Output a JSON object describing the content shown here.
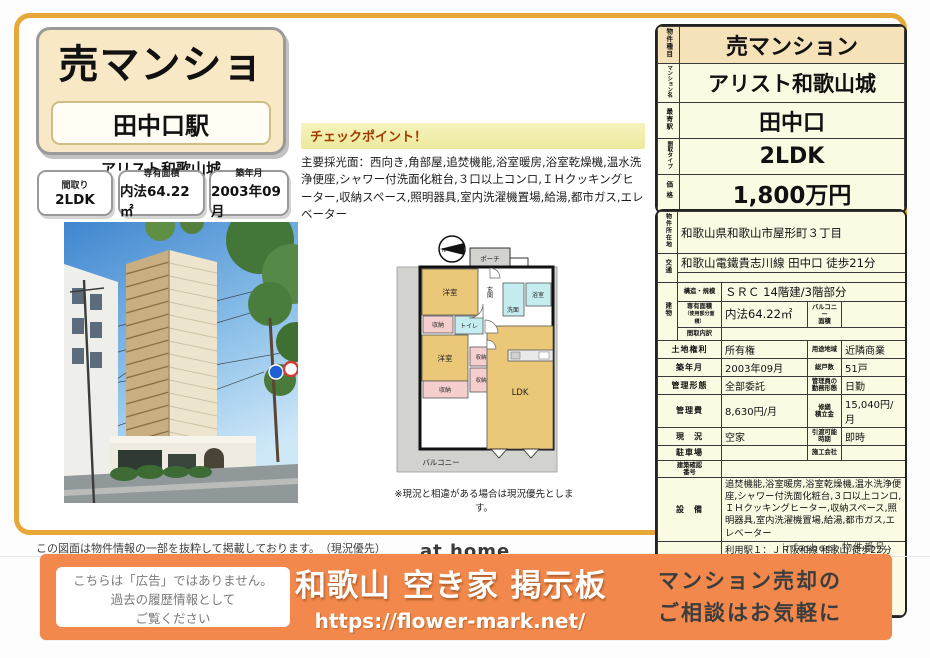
{
  "header": {
    "property_type": "売マンション",
    "station": "田中口駅",
    "building_name": "アリスト和歌山城",
    "specs": [
      {
        "label": "間取り",
        "value": "2LDK"
      },
      {
        "label": "専有面積",
        "value": "内法64.22㎡"
      },
      {
        "label": "築年月",
        "value": "2003年09月"
      }
    ]
  },
  "checkpoint": {
    "title": "チェックポイント！",
    "body": "主要採光面：西向き,角部屋,追焚機能,浴室暖房,浴室乾燥機,温水洗浄便座,シャワー付洗面化粧台,３口以上コンロ,ＩＨクッキングヒーター,収納スペース,照明器具,室内洗濯機置場,給湯,都市ガス,エレベーター"
  },
  "summary_table": {
    "rows": [
      {
        "label": "物件種目",
        "value": "売マンション"
      },
      {
        "label": "マンション名",
        "value": "アリスト和歌山城"
      },
      {
        "label": "最寄駅",
        "value": "田中口"
      },
      {
        "label": "間取タイプ",
        "value": "2LDK"
      },
      {
        "label": "価格",
        "value": "1,800万円"
      }
    ]
  },
  "details": {
    "location_label": "物件所在地",
    "location": "和歌山県和歌山市屋形町３丁目",
    "access_label": "交通",
    "access": "和歌山電鐵貴志川線 田中口 徒歩21分",
    "access2": "",
    "building_label": "建物",
    "structure_label": "構造・規模",
    "structure": "ＳＲＣ 14階建/3階部分",
    "area_label": "専有面積",
    "area_sublabel": "（使用部分面積）",
    "area": "内法64.22㎡",
    "balcony_label1": "バルコニー",
    "balcony_label2": "面積",
    "balcony": "",
    "madori_label": "間取内訳",
    "madori": "",
    "land_label": "土地権利",
    "land": "所有権",
    "zoning_label": "用途地域",
    "zoning": "近隣商業",
    "built_label": "築年月",
    "built": "2003年09月",
    "units_label": "総戸数",
    "units": "51戸",
    "mgmt_type_label": "管理形態",
    "mgmt_type": "全部委託",
    "mgr_label1": "管理員の",
    "mgr_label2": "勤務形態",
    "mgr": "日勤",
    "fee_label": "管理費",
    "fee": "8,630円/月",
    "repair_label1": "修繕",
    "repair_label2": "積立金",
    "repair": "15,040円/月",
    "status_label": "現　況",
    "status": "空家",
    "handover_label1": "引渡可能",
    "handover_label2": "時期",
    "handover": "即時",
    "parking_label": "駐車場",
    "parking": "",
    "constructor_label": "施工会社",
    "constructor": "",
    "confirm_label1": "建築確認",
    "confirm_label2": "番号",
    "confirm": "",
    "equipment_label": "設　備",
    "equipment": "追焚機能,浴室暖房,浴室乾燥機,温水洗浄便座,シャワー付洗面化粧台,３口以上コンロ,ＩＨクッキングヒーター,収納スペース,照明器具,室内洗濯機置場,給湯,都市ガス,エレベーター",
    "remarks_label": "備　考",
    "remarks": "利用駅１：ＪＲ阪和線 和歌山 徒歩22分　利用駅２：ＪＲ紀勢本線 紀和 徒歩24分"
  },
  "floorplan": {
    "caption": "※現況と相違がある場合は現況優先とします。",
    "labels": {
      "north": "N",
      "porch": "ポーチ",
      "mb": "MB",
      "genkan": "玄関",
      "room1": "洋室",
      "room2": "洋室",
      "senmen": "洗面",
      "bath": "浴室",
      "closet1": "収納",
      "closet2": "収納",
      "closet3": "収納",
      "closet4": "収納",
      "toilet": "トイレ",
      "ldk": "LDK",
      "balcony": "バルコニー"
    }
  },
  "footer": {
    "disclaimer": "この図面は物件情報の一部を抜粋して掲載しております。　（現況優先）",
    "athome_logo": "at home",
    "infosheet": "infosheet 物件番号"
  },
  "banner": {
    "notice_line1": "こちらは「広告」ではありません。",
    "notice_line2": "過去の履歴情報として",
    "notice_line3": "ご覧ください",
    "title": "和歌山 空き家 掲示板",
    "url": "https://flower-mark.net/",
    "cta_line1": "マンション売却の",
    "cta_line2": "ご相談はお気軽に",
    "accent_color": "#F2884B"
  }
}
